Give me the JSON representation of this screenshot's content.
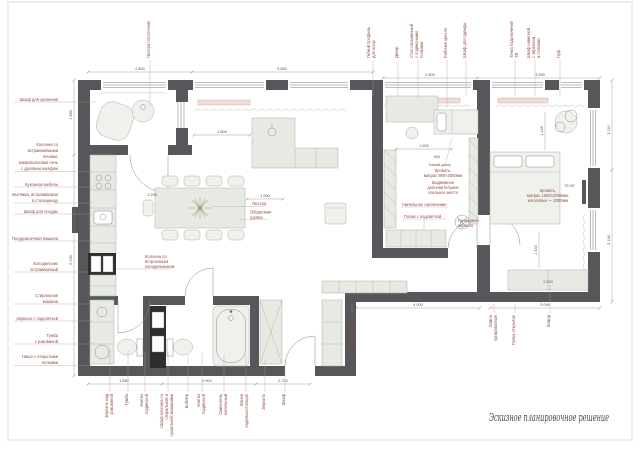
{
  "page": {
    "title": "Эскизное планировочное решение"
  },
  "labels": {
    "left": [
      "Шкаф для хранения",
      "Колонна со",
      "встраиваемыми",
      "печами:",
      "микроволновая печь",
      "с духовым шкафом",
      "Кухонная мебель",
      "Вытяжка, встраиваемая",
      "в столешницу",
      "Шкаф для посуды",
      "Посудомоечная машина",
      "Холодильник",
      "встраиваемый",
      "Стиральная",
      "машина",
      "Зеркало с подсветкой",
      "Тумба",
      "с раковиной",
      "Ниша с открытыми",
      "полками"
    ],
    "top": [
      "Люстра потолочная",
      "Гибкий профиль",
      "для штор",
      "Декор",
      "Стол письменный",
      "с подвесными",
      "полками",
      "Рабочее кресло",
      "Шкаф для одежды",
      "Точка подключения",
      "ТВ",
      "Шкаф навесной",
      "с зеркалом",
      "и полками",
      "Пуф"
    ],
    "bottom": [
      "Зеркало над",
      "раковиной",
      "Тумба",
      "Унитаз",
      "подвесной",
      "Шкаф-колонна со",
      "стиральной и",
      "сушильной машинами",
      "Бойлер",
      "Унитаз",
      "подвесной",
      "Смеситель",
      "напольный",
      "Ванна",
      "отдельностоящая",
      "Зеркало",
      "Шкаф",
      "Стеллаж с крючками,",
      "обувница, полки",
      "Лампа",
      "прикроватная",
      "Полка открытая",
      "Комод"
    ],
    "plan": [
      "Люстра",
      "Обеденная",
      "группа",
      "Колонна со",
      "встроенным",
      "холодильником",
      "Кровать,",
      "матрас 900×2000мм",
      "Выдвижное",
      "дополнительное",
      "спальное место",
      "Ампельное озеленение",
      "Полки с подсветкой",
      "Гримерное",
      "зеркало",
      "Кровать,",
      "матрас 1600×2000мм,",
      "изголовье — 2000мм",
      "ТВ 55″",
      "Тканый декор"
    ]
  },
  "dimensions": [
    "2 800",
    "5 550",
    "2 800",
    "3 090",
    "1 680",
    "2 900",
    "2 720",
    "4 000",
    "3 090",
    "1 985",
    "5 195",
    "3 110",
    "5 130",
    "1 805",
    "1 600",
    "1 000",
    "1 200",
    "1 145",
    "1 445",
    "2 200",
    "920"
  ],
  "colors": {
    "wall": "#56575a",
    "furniture": "#e6eae2",
    "annotation": "#8f4a42",
    "dimension": "#4f4f4f",
    "window_sill": "#f0ddda"
  }
}
